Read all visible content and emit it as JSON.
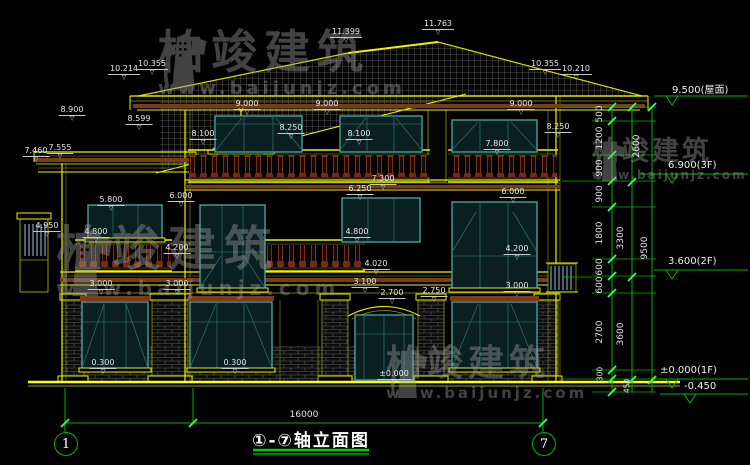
{
  "drawing": {
    "title": "①-⑦轴立面图",
    "overall_width_dim": "16000",
    "axis_left": "1",
    "axis_right": "7",
    "leader_glyph": "▽"
  },
  "watermark": {
    "brand": "柏竣建筑",
    "url": "www.baijunjz.com"
  },
  "elevation_markers": [
    {
      "text": "9.500(屋面)",
      "x": 672,
      "y": 81
    },
    {
      "text": "6.900(3F)",
      "x": 668,
      "y": 160
    },
    {
      "text": "3.600(2F)",
      "x": 668,
      "y": 256
    },
    {
      "text": "±0.000(1F)",
      "x": 660,
      "y": 365
    },
    {
      "text": "-0.450",
      "x": 684,
      "y": 381
    }
  ],
  "dim_chain_inner": [
    {
      "text": "500",
      "x": 600,
      "y": 114
    },
    {
      "text": "1200",
      "x": 600,
      "y": 138
    },
    {
      "text": "900",
      "x": 600,
      "y": 168
    },
    {
      "text": "900",
      "x": 600,
      "y": 194
    },
    {
      "text": "1800",
      "x": 600,
      "y": 233
    },
    {
      "text": "600",
      "x": 600,
      "y": 267
    },
    {
      "text": "600",
      "x": 600,
      "y": 285
    },
    {
      "text": "2700",
      "x": 600,
      "y": 332
    },
    {
      "text": "300",
      "x": 600,
      "y": 374
    },
    {
      "text": "450",
      "x": 627,
      "y": 386
    }
  ],
  "dim_chain_middle": [
    {
      "text": "2600",
      "x": 637,
      "y": 146
    },
    {
      "text": "3300",
      "x": 621,
      "y": 238
    },
    {
      "text": "3600",
      "x": 621,
      "y": 334
    }
  ],
  "dim_chain_outer": [
    {
      "text": "9500",
      "x": 645,
      "y": 248
    }
  ],
  "dim_labels": [
    {
      "text": "11.399",
      "x": 346,
      "y": 28
    },
    {
      "text": "11.763",
      "x": 438,
      "y": 20
    },
    {
      "text": "10.214",
      "x": 124,
      "y": 65
    },
    {
      "text": "10.355",
      "x": 152,
      "y": 60
    },
    {
      "text": "10.355",
      "x": 545,
      "y": 60
    },
    {
      "text": "10.210",
      "x": 576,
      "y": 65
    },
    {
      "text": "8.900",
      "x": 72,
      "y": 106
    },
    {
      "text": "8.599",
      "x": 139,
      "y": 115
    },
    {
      "text": "9.000",
      "x": 247,
      "y": 100
    },
    {
      "text": "9.000",
      "x": 327,
      "y": 100
    },
    {
      "text": "9.000",
      "x": 521,
      "y": 100
    },
    {
      "text": "8.100",
      "x": 203,
      "y": 130
    },
    {
      "text": "8.250",
      "x": 291,
      "y": 124
    },
    {
      "text": "8.100",
      "x": 359,
      "y": 130
    },
    {
      "text": "7.800",
      "x": 497,
      "y": 140
    },
    {
      "text": "8.250",
      "x": 558,
      "y": 123
    },
    {
      "text": "7.460",
      "x": 36,
      "y": 147
    },
    {
      "text": "7.555",
      "x": 60,
      "y": 144
    },
    {
      "text": "7.300",
      "x": 383,
      "y": 175
    },
    {
      "text": "6.250",
      "x": 360,
      "y": 185
    },
    {
      "text": "6.000",
      "x": 181,
      "y": 192
    },
    {
      "text": "5.800",
      "x": 111,
      "y": 196
    },
    {
      "text": "6.000",
      "x": 513,
      "y": 188
    },
    {
      "text": "4.950",
      "x": 47,
      "y": 222
    },
    {
      "text": "4.800",
      "x": 96,
      "y": 228
    },
    {
      "text": "4.800",
      "x": 357,
      "y": 228
    },
    {
      "text": "4.200",
      "x": 177,
      "y": 244
    },
    {
      "text": "4.200",
      "x": 517,
      "y": 245
    },
    {
      "text": "4.020",
      "x": 376,
      "y": 260
    },
    {
      "text": "3.100",
      "x": 365,
      "y": 278
    },
    {
      "text": "3.000",
      "x": 101,
      "y": 280
    },
    {
      "text": "3.000",
      "x": 177,
      "y": 280
    },
    {
      "text": "3.000",
      "x": 517,
      "y": 282
    },
    {
      "text": "2.700",
      "x": 392,
      "y": 289
    },
    {
      "text": "2.750",
      "x": 434,
      "y": 287
    },
    {
      "text": "0.300",
      "x": 103,
      "y": 359
    },
    {
      "text": "0.300",
      "x": 235,
      "y": 359
    },
    {
      "text": "±0.000",
      "x": 394,
      "y": 370
    }
  ],
  "colors": {
    "line_yellow": "#f0f000",
    "line_olive": "#9c9c00",
    "band_brown": "#7a3a1c",
    "window_teal": "#47a0a0",
    "dim_green": "#00b400",
    "tick_green": "#39ff5a",
    "text_white": "#e6e6e6",
    "ground_yellow": "#ffff00"
  }
}
